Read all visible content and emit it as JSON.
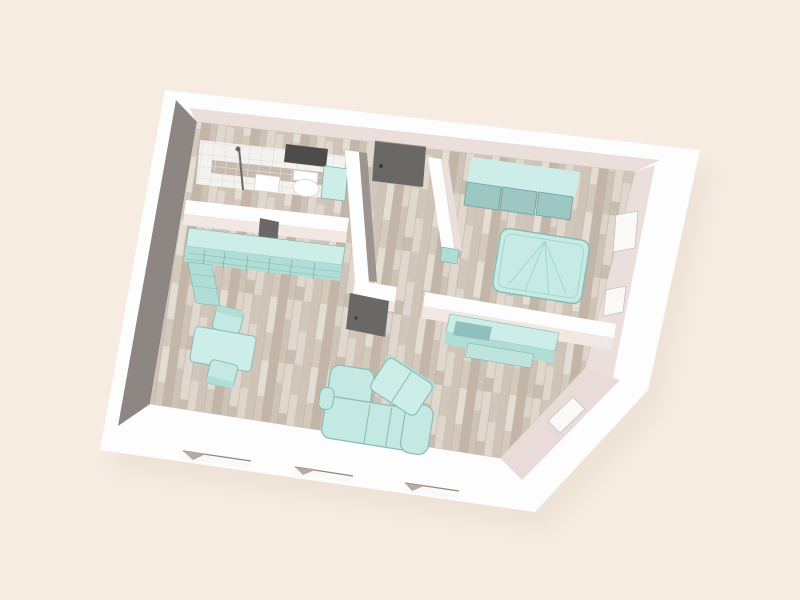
{
  "view": {
    "type": "3d-floor-plan-render",
    "projection": "aerial-oblique-perspective"
  },
  "colors": {
    "ground": "#f6ece2",
    "shadow": "#e8dbcd",
    "exterior_wall": "#fdfdfd",
    "interior_wall_light": "#eadfdb",
    "interior_wall_lighter": "#f1e8e4",
    "interior_wall_shadow": "#8d8683",
    "interior_wall_shadow_soft": "#9b948f",
    "chamfer_wall": "#e9dcd8",
    "floor_wood_base": "#d8cec3",
    "plank_a": "#cfc4b7",
    "plank_b": "#e4ddd4",
    "plank_c": "#c3b6a8",
    "plank_line": "#bfb3a5",
    "tile_floor": "#f4f2ef",
    "tile_line": "#d9d5d0",
    "tile_wall_band": "#c6baae",
    "tile_wall_line": "#efebe6",
    "furniture_teal_top": "#cdeee8",
    "furniture_teal_mid": "#b0ded7",
    "furniture_teal_dark": "#8fc0bb",
    "furniture_teal_stroke": "#7fb2ad",
    "sofa_fill": "#c3e9e2",
    "sofa_stroke": "#8abbb5",
    "bed_fill": "#c6ebe4",
    "bed_stroke": "#85bab4",
    "bed_crease": "#a5d4ce",
    "wardrobe_panel": "#9dc7c3",
    "wardrobe_panel_stroke": "#6fa39f",
    "door_panel": "#6a6866",
    "door_handle": "#3e3c3a",
    "window_recess": "#4e4c4a",
    "white_fixture": "#ffffff",
    "fixture_stroke": "#d8d4d0",
    "window_opening": "#fbf9f7",
    "window_line": "#8f8883",
    "window_frame": "#c9c1bb",
    "window_shade_tri": "#b3aba4",
    "media_unit": "#bfe4de"
  },
  "rooms": [
    {
      "id": "bathroom",
      "fixtures": [
        "shower",
        "sink",
        "toilet",
        "bathtub",
        "wall-window",
        "open-door"
      ]
    },
    {
      "id": "kitchen",
      "fixtures": [
        "l-shaped-counter"
      ]
    },
    {
      "id": "living-dining",
      "fixtures": [
        "dining-table",
        "dining-chair",
        "dining-chair",
        "corner-sofa",
        "loveseat",
        "tv-sideboard",
        "media-unit",
        "open-door"
      ]
    },
    {
      "id": "hallway",
      "fixtures": [
        "entry-door",
        "radiator"
      ]
    },
    {
      "id": "bedroom",
      "fixtures": [
        "double-bed",
        "sliding-door-wardrobe"
      ]
    }
  ],
  "openings": {
    "front_windows": 3,
    "right_wall_windows": 2,
    "corner_window": 1,
    "bathroom_window": 1,
    "doors": [
      "entry-door",
      "living-room-door",
      "bathroom-door"
    ]
  }
}
